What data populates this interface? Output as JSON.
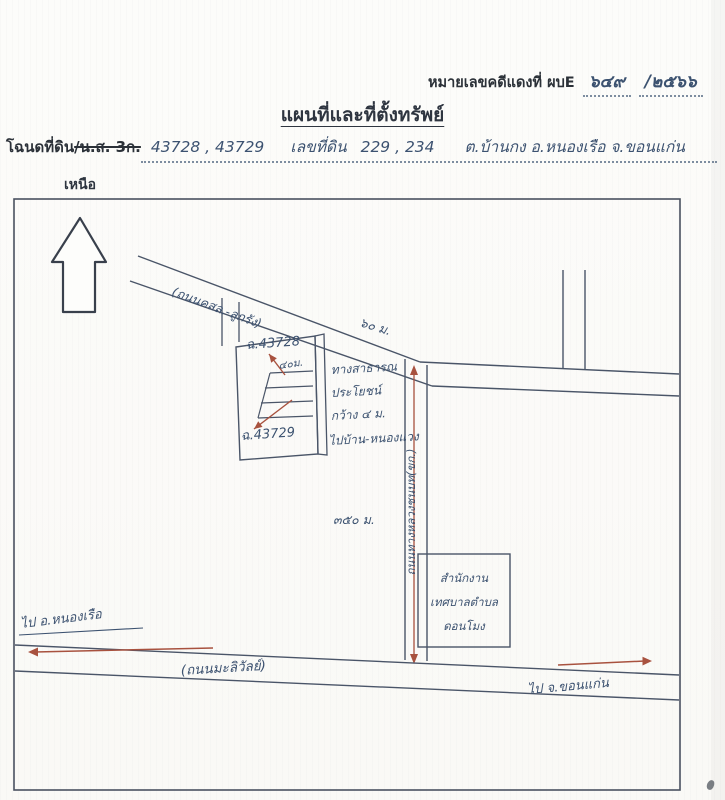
{
  "header": {
    "case_label": "หมายเลขคดีแดงที่ ผบE",
    "case_number": "๖๔๙",
    "case_year": "/๒๕๖๖",
    "title": "แผนที่และที่ตั้งทรัพย์"
  },
  "deed_line": {
    "label_deed": "โฉนดที่ดิน",
    "label_ns3k": "/น.ส. 3ก.",
    "deed_numbers": "43728 , 43729",
    "parcel_label": "เลขที่ดิน",
    "parcel_numbers": "229 , 234",
    "location": "ต.บ้านกง  อ.หนองเรือ  จ.ขอนแก่น"
  },
  "compass": {
    "north_label": "เหนือ"
  },
  "map": {
    "diagonal_road_label": "(ถนนคสล.-ลูกรัง)",
    "frontage_60": "๖๐ ม.",
    "depth_40": "๔๐ม.",
    "distance_350": "๓๕๐ ม.",
    "parcel_upper_label": "ฉ.43728",
    "parcel_lower_label": "ฉ.43729",
    "note_line1": "ทางสาธารณ",
    "note_line2": "ประโยชน์",
    "note_line3": "กว้าง ๔ ม.",
    "note_line4": "ไปบ้าน-หนองแวง",
    "vertical_road_label": "ถนนทางหลวงชนบท(ขก.)",
    "office_line1": "สำนักงาน",
    "office_line2": "เทศบาลตำบล",
    "office_line3": "ดอนโมง",
    "bottom_road_label": "(ถนนมะลิวัลย์)",
    "dest_left": "ไป อ.หนองเรือ",
    "dest_right": "ไป จ.ขอนแก่น"
  },
  "colors": {
    "ink": "#2e3540",
    "hand_ink": "#3c5270",
    "accent_red": "#a8523f"
  }
}
